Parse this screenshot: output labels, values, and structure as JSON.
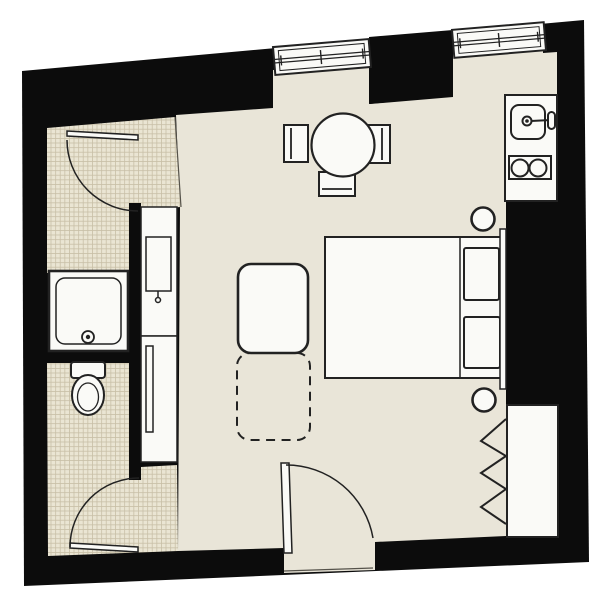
{
  "meta": {
    "description": "studio apartment floor plan"
  },
  "colors": {
    "background": "#ffffff",
    "wall": "#0c0c0c",
    "floor": "#e9e5d8",
    "tile_base": "#eae5d3",
    "tile_grid": "#c8bfa7",
    "fixture": "#fafaf7",
    "line": "#222222",
    "line_soft": "#55524a"
  },
  "elements": {
    "outline": "exterior-walls",
    "main_room": "main-living-room-floor",
    "shower_room": "shower-room-tiled-floor",
    "wc_room": "wc-tiled-floor",
    "window_1": "window",
    "window_2": "window",
    "kitchen_counter": "kitchen-counter",
    "sink": "kitchen-sink",
    "stove": "two-burner-stove",
    "dining_table": "round-dining-table",
    "chair": "dining-chair",
    "bed": "double-bed",
    "pillow": "pillow",
    "stool": "bedside-stool",
    "sofa": "sofa",
    "sofa_ext": "sofa-bed-extension",
    "wardrobe": "wardrobe-niche",
    "hanging": "hanging-clothes-symbol",
    "shower": "shower-tray",
    "toilet": "toilet",
    "basin": "washbasin-unit",
    "cabinet": "tall-cabinet",
    "door": "swing-door",
    "threshold": "entrance-threshold"
  }
}
